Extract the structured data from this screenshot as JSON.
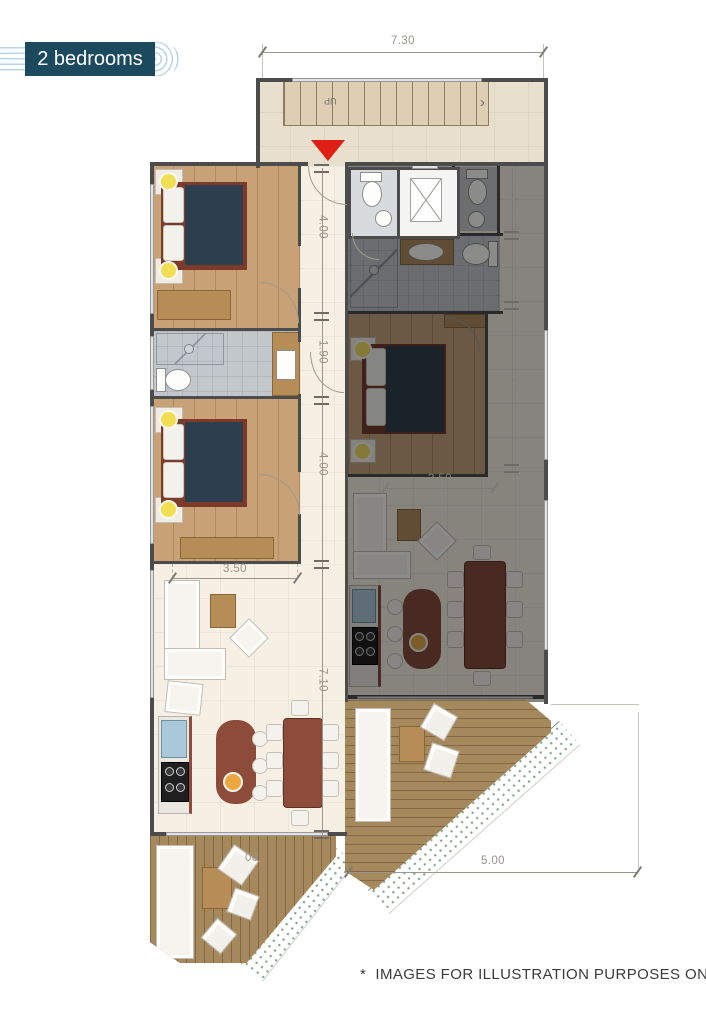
{
  "badge": {
    "label": "2 bedrooms"
  },
  "stairs": {
    "up_label": "UP",
    "arrow": "›"
  },
  "dimensions": {
    "top_width": "7.30",
    "left_chain": [
      "4.00",
      "1.90",
      "4.00",
      "7.10"
    ],
    "right_chain": [
      "1.75",
      "1.90",
      "4.00"
    ],
    "living_width_left": "3.50",
    "living_width_right": "3.50",
    "bottom_width": "5.00",
    "terrace_partial": "00"
  },
  "footer": {
    "disclaimer": "*  IMAGES FOR ILLUSTRATION PURPOSES ONLY"
  },
  "colors": {
    "badge_bg": "#1b4a5f",
    "badge_ring": "#b9d6e6",
    "accent_red": "#df1f16",
    "wall": "#4c4c4c",
    "wood_floor": "#c8a176",
    "deck_wood": "#a5885c",
    "bed_navy": "#2d3e4f",
    "furniture_maroon": "#8d4b3a",
    "tile_gray": "#c2c7cc",
    "dim_text": "#98948c",
    "floor_cream": "#f6efe4",
    "hall_floor": "#e9dfcd"
  }
}
